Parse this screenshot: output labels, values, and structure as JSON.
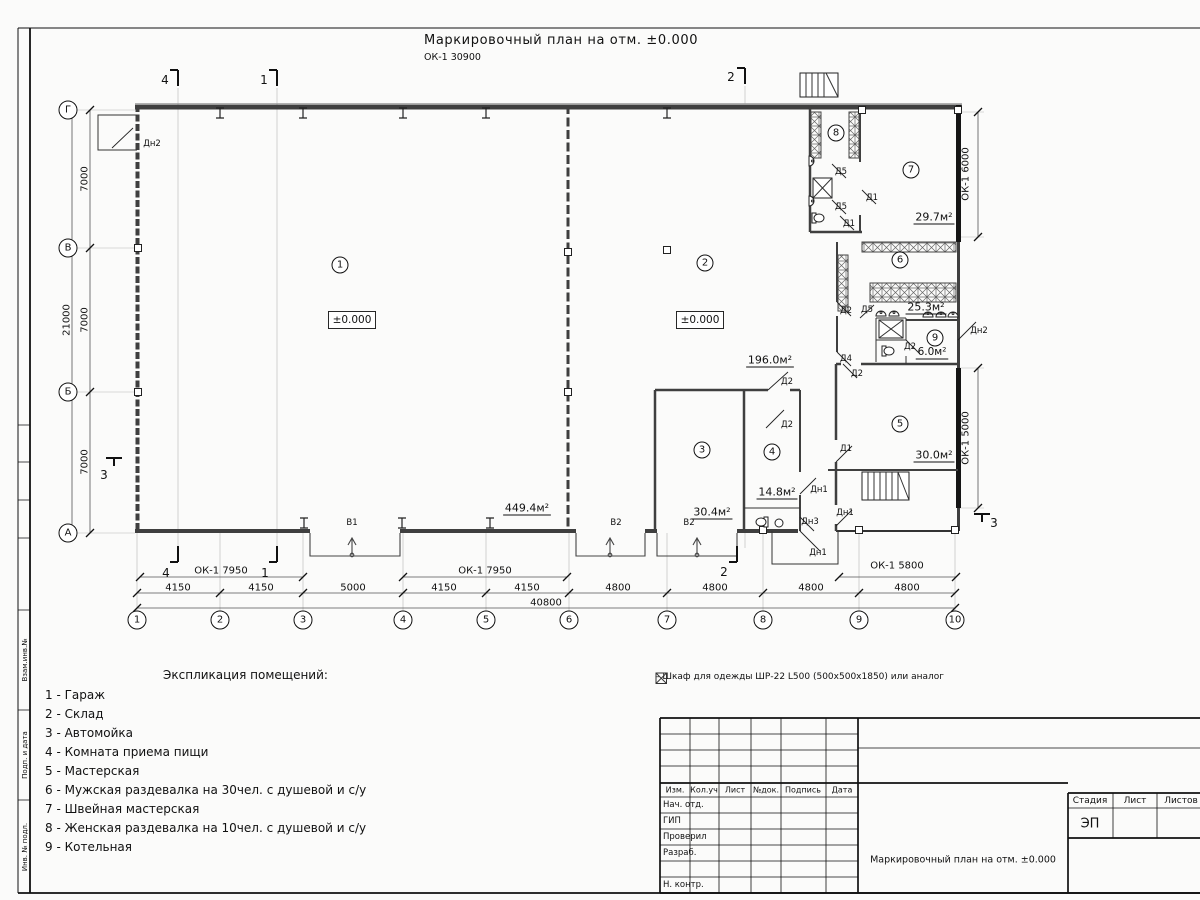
{
  "sheet": {
    "title": "Маркировочный план на отм. ±0.000",
    "subtitle": "ОК-1 30900"
  },
  "legend": {
    "heading": "Экспликация помещений:",
    "items": [
      "1 - Гараж",
      "2 - Склад",
      "3 - Автомойка",
      "4 - Комната приема пищи",
      "5 - Мастерская",
      "6 - Мужская раздевалка на 30чел. с душевой и с/у",
      "7 - Швейная мастерская",
      "8 - Женская раздевалка на 10чел. с душевой и с/у",
      "9 - Котельная"
    ]
  },
  "note": {
    "symbol": "wardrobe-crossed-box",
    "text": "– Шкаф для одежды ШР-22 L500 (500x500x1850) или аналог"
  },
  "plan": {
    "labels": [
      {
        "t": "4150",
        "x": 178,
        "y": 588
      },
      {
        "t": "4150",
        "x": 261,
        "y": 588
      },
      {
        "t": "5000",
        "x": 353,
        "y": 588
      },
      {
        "t": "4150",
        "x": 444,
        "y": 588
      },
      {
        "t": "4150",
        "x": 527,
        "y": 588
      },
      {
        "t": "4800",
        "x": 618,
        "y": 588
      },
      {
        "t": "4800",
        "x": 715,
        "y": 588
      },
      {
        "t": "4800",
        "x": 811,
        "y": 588
      },
      {
        "t": "4800",
        "x": 907,
        "y": 588
      },
      {
        "t": "40800",
        "x": 546,
        "y": 603
      },
      {
        "t": "ОК-1 7950",
        "x": 221,
        "y": 571
      },
      {
        "t": "ОК-1 7950",
        "x": 485,
        "y": 571
      },
      {
        "t": "ОК-1 5800",
        "x": 897,
        "y": 566
      },
      {
        "t": "7000",
        "x": 85,
        "y": 179,
        "r": -90
      },
      {
        "t": "7000",
        "x": 85,
        "y": 320,
        "r": -90
      },
      {
        "t": "7000",
        "x": 85,
        "y": 462,
        "r": -90
      },
      {
        "t": "21000",
        "x": 67,
        "y": 320,
        "r": -90
      },
      {
        "t": "ОК-1 6000",
        "x": 966,
        "y": 174,
        "r": -90
      },
      {
        "t": "ОК-1 5000",
        "x": 966,
        "y": 438,
        "r": -90
      },
      {
        "t": "1",
        "x": 137,
        "y": 620,
        "c": 9
      },
      {
        "t": "2",
        "x": 220,
        "y": 620,
        "c": 9
      },
      {
        "t": "3",
        "x": 303,
        "y": 620,
        "c": 9
      },
      {
        "t": "4",
        "x": 403,
        "y": 620,
        "c": 9
      },
      {
        "t": "5",
        "x": 486,
        "y": 620,
        "c": 9
      },
      {
        "t": "6",
        "x": 569,
        "y": 620,
        "c": 9
      },
      {
        "t": "7",
        "x": 667,
        "y": 620,
        "c": 9
      },
      {
        "t": "8",
        "x": 763,
        "y": 620,
        "c": 9
      },
      {
        "t": "9",
        "x": 859,
        "y": 620,
        "c": 9
      },
      {
        "t": "10",
        "x": 955,
        "y": 620,
        "c": 9
      },
      {
        "t": "Г",
        "x": 68,
        "y": 110,
        "c": 9
      },
      {
        "t": "В",
        "x": 68,
        "y": 248,
        "c": 9
      },
      {
        "t": "Б",
        "x": 68,
        "y": 392,
        "c": 9
      },
      {
        "t": "А",
        "x": 68,
        "y": 533,
        "c": 9
      },
      {
        "t": "4",
        "x": 165,
        "y": 80,
        "s": 12
      },
      {
        "t": "1",
        "x": 264,
        "y": 80,
        "s": 12
      },
      {
        "t": "2",
        "x": 731,
        "y": 77,
        "s": 12
      },
      {
        "t": "4",
        "x": 166,
        "y": 573,
        "s": 12
      },
      {
        "t": "1",
        "x": 265,
        "y": 573,
        "s": 12
      },
      {
        "t": "2",
        "x": 724,
        "y": 572,
        "s": 12
      },
      {
        "t": "3",
        "x": 104,
        "y": 475,
        "s": 12
      },
      {
        "t": "3",
        "x": 994,
        "y": 523,
        "s": 12
      },
      {
        "t": "1",
        "x": 340,
        "y": 265,
        "c": 8
      },
      {
        "t": "2",
        "x": 705,
        "y": 263,
        "c": 8
      },
      {
        "t": "3",
        "x": 702,
        "y": 450,
        "c": 8
      },
      {
        "t": "4",
        "x": 772,
        "y": 452,
        "c": 8
      },
      {
        "t": "5",
        "x": 900,
        "y": 424,
        "c": 8
      },
      {
        "t": "6",
        "x": 900,
        "y": 260,
        "c": 8
      },
      {
        "t": "7",
        "x": 911,
        "y": 170,
        "c": 8
      },
      {
        "t": "8",
        "x": 836,
        "y": 133,
        "c": 8
      },
      {
        "t": "9",
        "x": 935,
        "y": 338,
        "c": 8
      },
      {
        "t": "±0.000",
        "x": 352,
        "y": 320,
        "b": 1,
        "s": 10.5
      },
      {
        "t": "±0.000",
        "x": 700,
        "y": 320,
        "b": 1,
        "s": 10.5
      },
      {
        "t": "449.4м²",
        "x": 527,
        "y": 508,
        "u": 1,
        "s": 11
      },
      {
        "t": "196.0м²",
        "x": 770,
        "y": 360,
        "u": 1,
        "s": 11
      },
      {
        "t": "30.4м²",
        "x": 712,
        "y": 512,
        "u": 1,
        "s": 11
      },
      {
        "t": "14.8м²",
        "x": 777,
        "y": 492,
        "u": 1,
        "s": 11
      },
      {
        "t": "30.0м²",
        "x": 934,
        "y": 455,
        "u": 1,
        "s": 11
      },
      {
        "t": "25.3м²",
        "x": 926,
        "y": 307,
        "u": 1,
        "s": 11
      },
      {
        "t": "29.7м²",
        "x": 934,
        "y": 217,
        "u": 1,
        "s": 11
      },
      {
        "t": "6.0м²",
        "x": 932,
        "y": 352,
        "u": 1,
        "s": 10.5
      },
      {
        "t": "Дн2",
        "x": 152,
        "y": 144,
        "s": 8.5
      },
      {
        "t": "Д5",
        "x": 841,
        "y": 172,
        "s": 8.5
      },
      {
        "t": "Д1",
        "x": 872,
        "y": 198,
        "s": 8.5
      },
      {
        "t": "Д5",
        "x": 841,
        "y": 207,
        "s": 8.5
      },
      {
        "t": "Д1",
        "x": 849,
        "y": 224,
        "s": 8.5
      },
      {
        "t": "Д2",
        "x": 846,
        "y": 311,
        "s": 8.5
      },
      {
        "t": "Д5",
        "x": 867,
        "y": 310,
        "s": 8.5
      },
      {
        "t": "Д2",
        "x": 910,
        "y": 347,
        "s": 8.5
      },
      {
        "t": "Д4",
        "x": 846,
        "y": 359,
        "s": 8.5
      },
      {
        "t": "Д2",
        "x": 857,
        "y": 374,
        "s": 8.5
      },
      {
        "t": "Дн2",
        "x": 979,
        "y": 331,
        "s": 8.5
      },
      {
        "t": "Д2",
        "x": 787,
        "y": 382,
        "s": 8.5
      },
      {
        "t": "Д2",
        "x": 787,
        "y": 425,
        "s": 8.5
      },
      {
        "t": "Д1",
        "x": 846,
        "y": 449,
        "s": 8.5
      },
      {
        "t": "Дн1",
        "x": 819,
        "y": 490,
        "s": 8.5
      },
      {
        "t": "Дн1",
        "x": 845,
        "y": 513,
        "s": 8.5
      },
      {
        "t": "Дн3",
        "x": 810,
        "y": 522,
        "s": 8.5
      },
      {
        "t": "Дн1",
        "x": 818,
        "y": 553,
        "s": 8.5
      },
      {
        "t": "В1",
        "x": 352,
        "y": 523,
        "s": 8.5
      },
      {
        "t": "В2",
        "x": 616,
        "y": 523,
        "s": 8.5
      },
      {
        "t": "В2",
        "x": 689,
        "y": 523,
        "s": 8.5
      }
    ]
  },
  "titleblock": {
    "labels": [
      {
        "t": "Изм.",
        "x": 675,
        "y": 790,
        "s": 8
      },
      {
        "t": "Кол.уч",
        "x": 704,
        "y": 790,
        "s": 8
      },
      {
        "t": "Лист",
        "x": 735,
        "y": 790,
        "s": 8
      },
      {
        "t": "№док.",
        "x": 766,
        "y": 790,
        "s": 8
      },
      {
        "t": "Подпись",
        "x": 803,
        "y": 790,
        "s": 8
      },
      {
        "t": "Дата",
        "x": 842,
        "y": 790,
        "s": 8
      },
      {
        "t": "Нач. отд.",
        "x": 663,
        "y": 805,
        "s": 8.5,
        "a": "start"
      },
      {
        "t": "ГИП",
        "x": 663,
        "y": 821,
        "s": 8.5,
        "a": "start"
      },
      {
        "t": "Проверил",
        "x": 663,
        "y": 837,
        "s": 8.5,
        "a": "start"
      },
      {
        "t": "Разраб.",
        "x": 663,
        "y": 853,
        "s": 8.5,
        "a": "start"
      },
      {
        "t": "Н. контр.",
        "x": 663,
        "y": 885,
        "s": 8.5,
        "a": "start"
      },
      {
        "t": "Стадия",
        "x": 1090,
        "y": 801,
        "s": 9
      },
      {
        "t": "Лист",
        "x": 1135,
        "y": 801,
        "s": 9
      },
      {
        "t": "Листов",
        "x": 1181,
        "y": 801,
        "s": 9
      },
      {
        "t": "ЭП",
        "x": 1090,
        "y": 824,
        "s": 13
      },
      {
        "t": "Маркировочный план на отм. ±0.000",
        "x": 963,
        "y": 860,
        "s": 9.5
      }
    ]
  },
  "frame": {
    "labels": [
      {
        "t": "Взам.инв.№",
        "x": 25,
        "y": 660,
        "r": -90,
        "s": 7
      },
      {
        "t": "Подп. и дата",
        "x": 25,
        "y": 755,
        "r": -90,
        "s": 7
      },
      {
        "t": "Инв. № подл.",
        "x": 25,
        "y": 847,
        "r": -90,
        "s": 7
      }
    ]
  }
}
